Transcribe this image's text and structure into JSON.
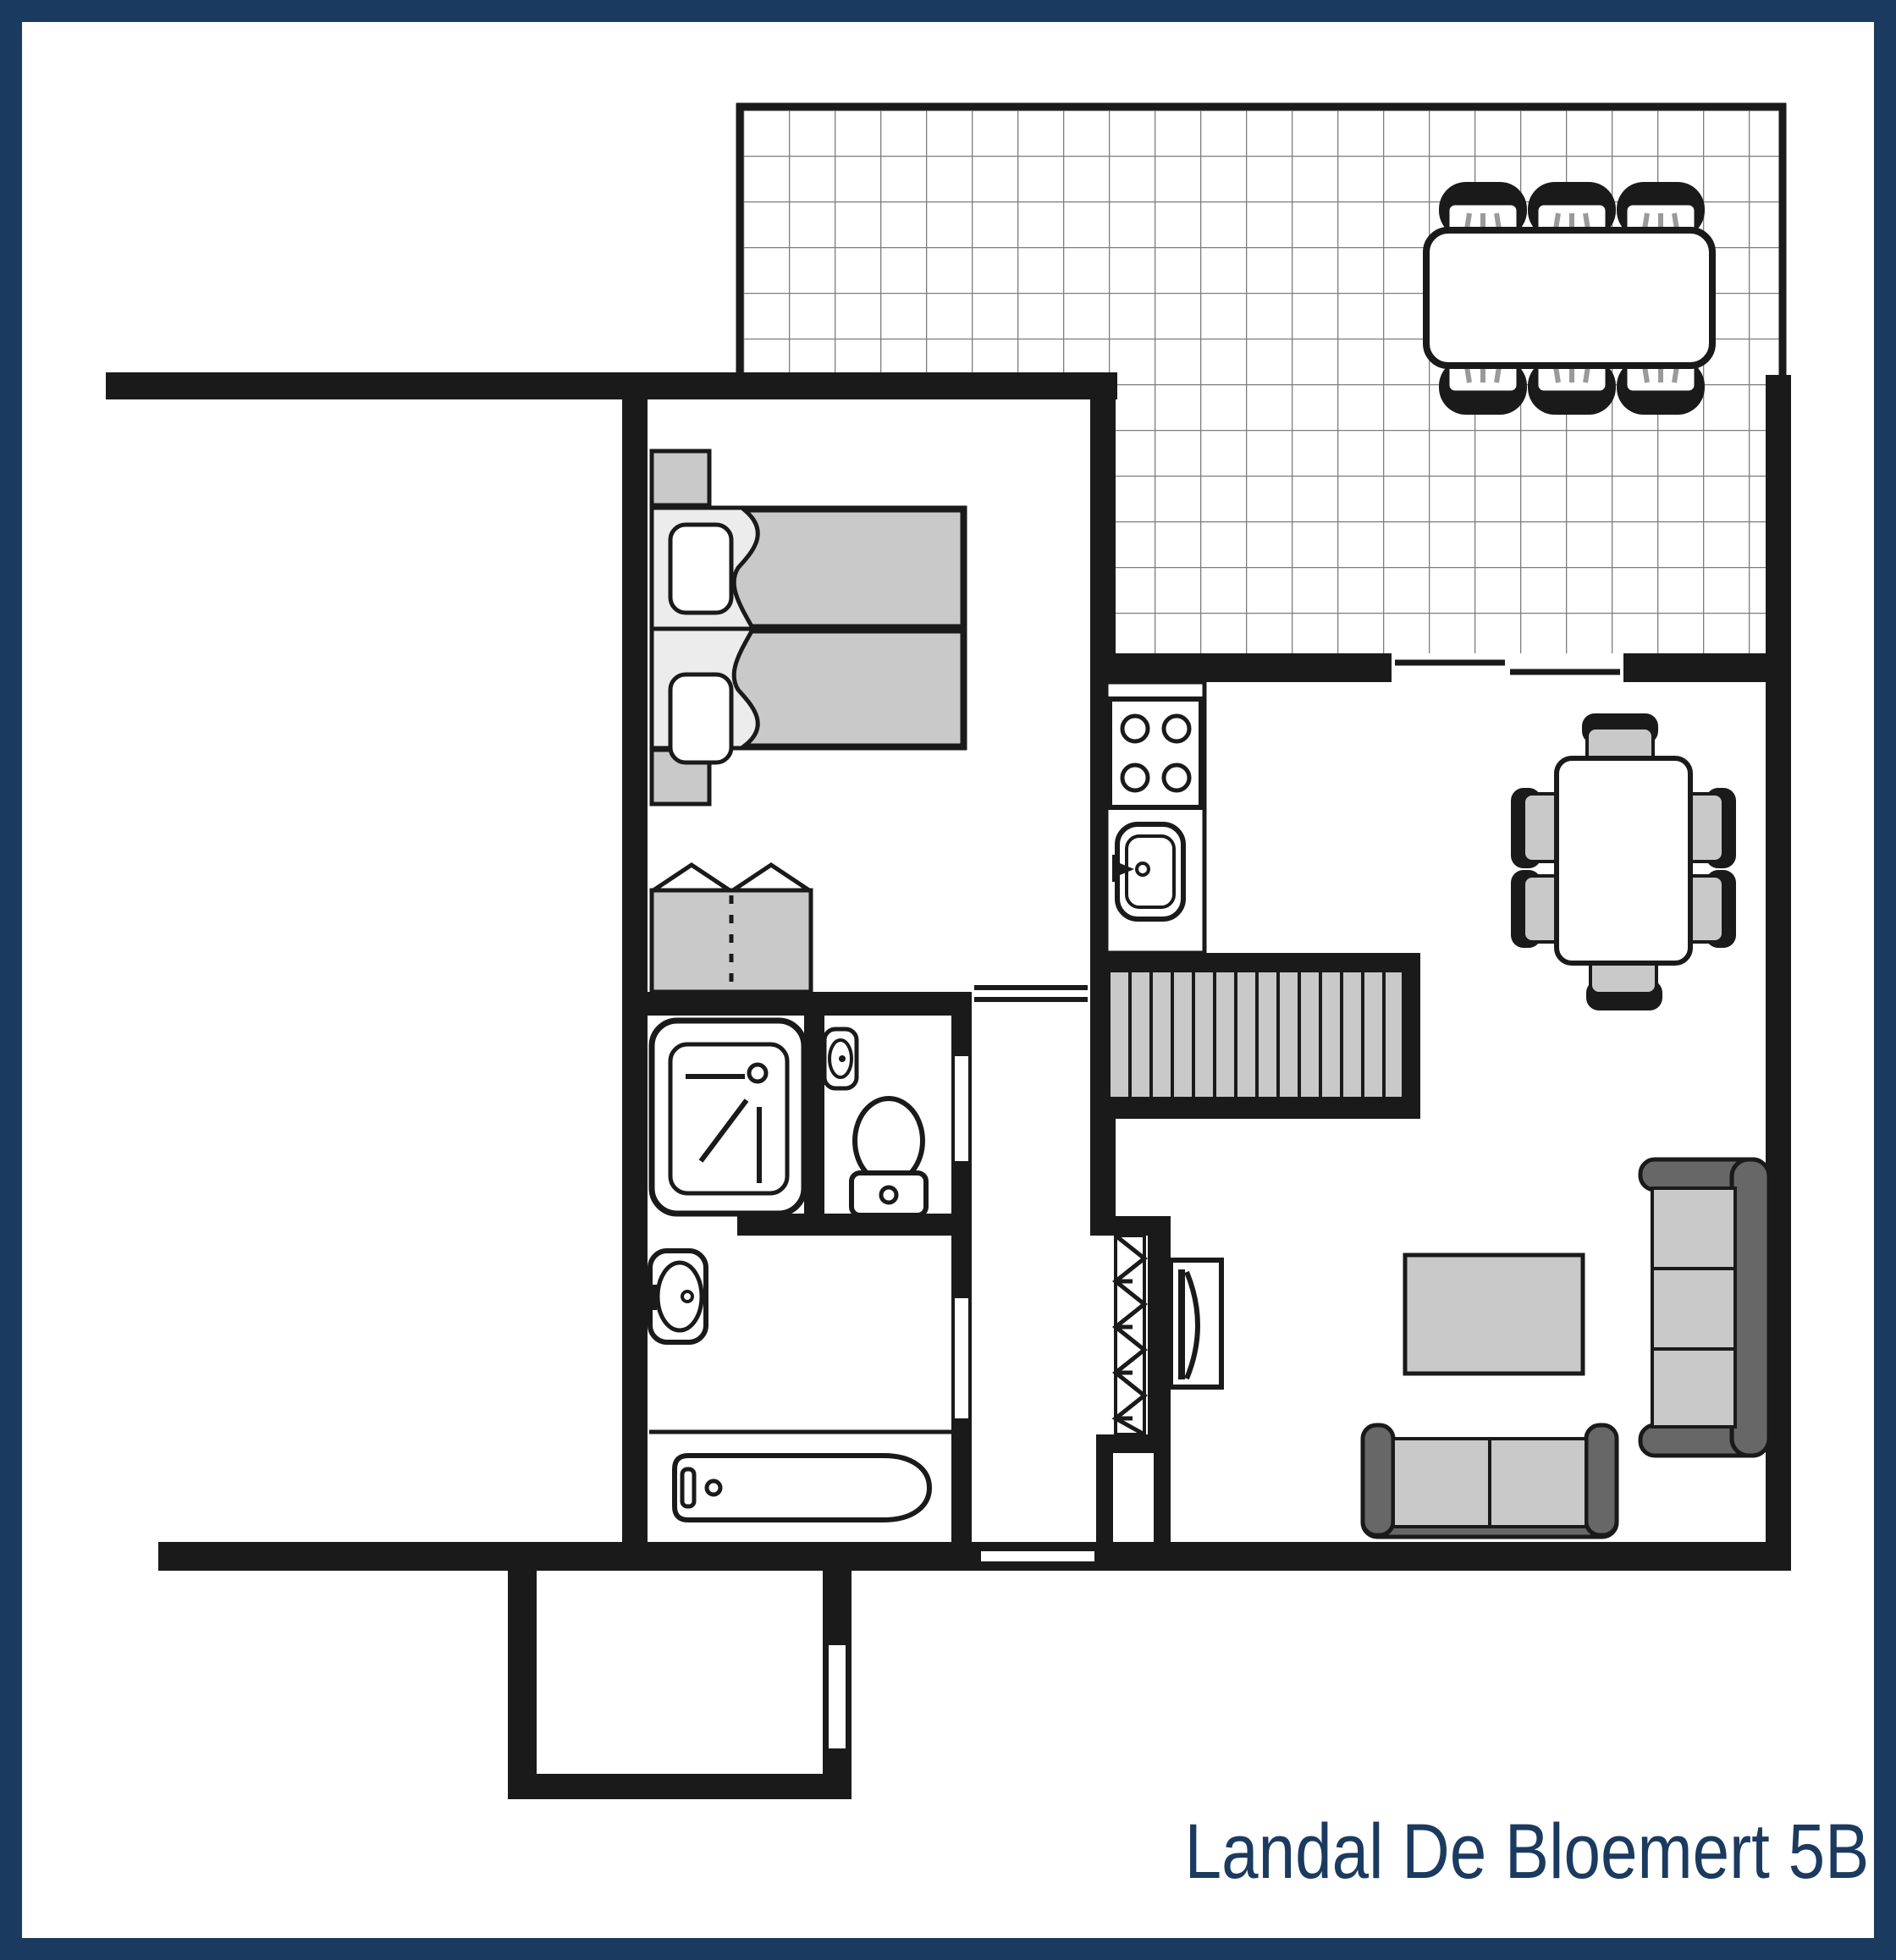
{
  "title": "Landal De Bloemert 5B",
  "colors": {
    "wall": "#1a1a1a",
    "navy": "#1b3a5f",
    "gray": "#c9c9c9",
    "lightgray": "#ececec",
    "sofadark": "#676767",
    "gridline": "#7d7d7d",
    "stripe": "#9a9a9a",
    "bg": "#ffffff"
  },
  "floorplan": {
    "type": "holiday-home ground floor plan",
    "rooms": [
      {
        "name": "terrace",
        "symbols": [
          "tile-grid",
          "outdoor-dining-table",
          "outdoor-chair",
          "outdoor-chair",
          "outdoor-chair",
          "outdoor-chair",
          "outdoor-chair",
          "outdoor-chair"
        ]
      },
      {
        "name": "bedroom",
        "symbols": [
          "single-bed",
          "single-bed",
          "pillow",
          "pillow",
          "nightstand",
          "nightstand",
          "wardrobe-with-hanging-rail",
          "door-opening"
        ]
      },
      {
        "name": "shower-room",
        "symbols": [
          "shower-cabin"
        ]
      },
      {
        "name": "wc",
        "symbols": [
          "toilet",
          "corner-hand-basin",
          "door-opening"
        ]
      },
      {
        "name": "bathroom",
        "symbols": [
          "wash-basin",
          "bathtub",
          "door-opening"
        ]
      },
      {
        "name": "kitchen",
        "symbols": [
          "hob-four-burners",
          "kitchen-sink",
          "counter"
        ]
      },
      {
        "name": "staircase",
        "symbols": [
          "stair-treads"
        ]
      },
      {
        "name": "dining-area",
        "symbols": [
          "dining-table",
          "dining-chair",
          "dining-chair",
          "dining-chair",
          "dining-chair",
          "dining-chair",
          "dining-chair",
          "sliding-door-to-terrace"
        ]
      },
      {
        "name": "living-room",
        "symbols": [
          "sofa-three-seat",
          "sofa-two-seat",
          "coffee-table",
          "tv",
          "radiator"
        ]
      },
      {
        "name": "hallway",
        "symbols": [
          "front-door-opening",
          "storage-niche"
        ]
      },
      {
        "name": "porch",
        "symbols": [
          "porch-door-opening"
        ]
      }
    ]
  }
}
